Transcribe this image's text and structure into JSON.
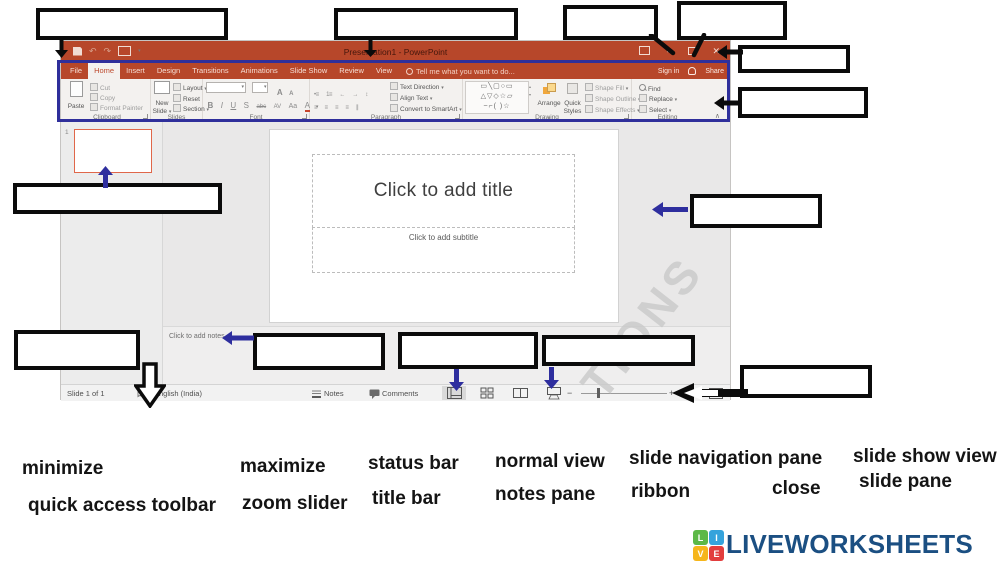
{
  "window_title": "Presentation1 - PowerPoint",
  "tabs": [
    "File",
    "Home",
    "Insert",
    "Design",
    "Transitions",
    "Animations",
    "Slide Show",
    "Review",
    "View"
  ],
  "tell_me": "Tell me what you want to do...",
  "account": {
    "sign_in": "Sign in",
    "share": "Share"
  },
  "glyphs": {
    "caret": "▾",
    "collapse": "∧",
    "undo": "↶",
    "redo": "↷",
    "minimize": "–",
    "close": "✕",
    "scroll_up": "▴",
    "scroll_down": "▾"
  },
  "ribbon": {
    "clipboard": {
      "label": "Clipboard",
      "paste": "Paste",
      "cut": "Cut",
      "copy": "Copy",
      "format_painter": "Format Painter"
    },
    "slides": {
      "label": "Slides",
      "new": "New",
      "slide": "Slide",
      "layout": "Layout",
      "reset": "Reset",
      "section": "Section"
    },
    "font": {
      "label": "Font",
      "bold": "B",
      "italic": "I",
      "underline": "U",
      "shadow": "S",
      "strike": "abc",
      "spacing": "AV",
      "case": "Aa",
      "color": "A",
      "grow": "A",
      "shrink": "A"
    },
    "paragraph": {
      "label": "Paragraph",
      "bullets": "•≡",
      "numbering": "1≡",
      "indent_less": "←",
      "indent_more": "→",
      "line_spacing": "↕",
      "align": "≡",
      "columns": "∥",
      "text_direction": "Text Direction",
      "align_text": "Align Text",
      "convert": "Convert to SmartArt"
    },
    "drawing": {
      "label": "Drawing",
      "shapes_r1": "▭╲▢○▭",
      "shapes_r2": "△▽◇☆▱",
      "shapes_r3": "~⌐( )☆",
      "arrange": "Arrange",
      "quick": "Quick",
      "styles": "Styles",
      "shape_fill": "Shape Fill",
      "shape_outline": "Shape Outline",
      "shape_effects": "Shape Effects"
    },
    "editing": {
      "label": "Editing",
      "find": "Find",
      "replace": "Replace",
      "select": "Select"
    }
  },
  "slide_panel": {
    "slide_number": "1"
  },
  "slide": {
    "title_ph": "Click to add title",
    "subtitle_ph": "Click to add subtitle"
  },
  "notes": {
    "placeholder": "Click to add notes"
  },
  "status_bar": {
    "slide_count": "Slide 1 of 1",
    "language": "English (India)",
    "notes": "Notes",
    "comments": "Comments",
    "zoom_out": "−",
    "zoom_in": "+"
  },
  "watermark": "TIONS",
  "word_bank": [
    "minimize",
    "quick access toolbar",
    "maximize",
    "zoom slider",
    "status bar",
    "title bar",
    "normal view",
    "notes pane",
    "slide navigation pane",
    "ribbon",
    "close",
    "slide show view",
    "slide pane"
  ],
  "logo": {
    "text": "LIVEWORKSHEETS",
    "squares": [
      {
        "letter": "L",
        "color": "#5cb847"
      },
      {
        "letter": "I",
        "color": "#35a3dc"
      },
      {
        "letter": "V",
        "color": "#f6b61b"
      },
      {
        "letter": "E",
        "color": "#e23d3d"
      }
    ]
  },
  "colors": {
    "title_bar": "#B7472A",
    "annotation_blue": "#2F2F9B",
    "thumbnail_border": "#E0674A",
    "logo_blue": "#1b4f82"
  }
}
